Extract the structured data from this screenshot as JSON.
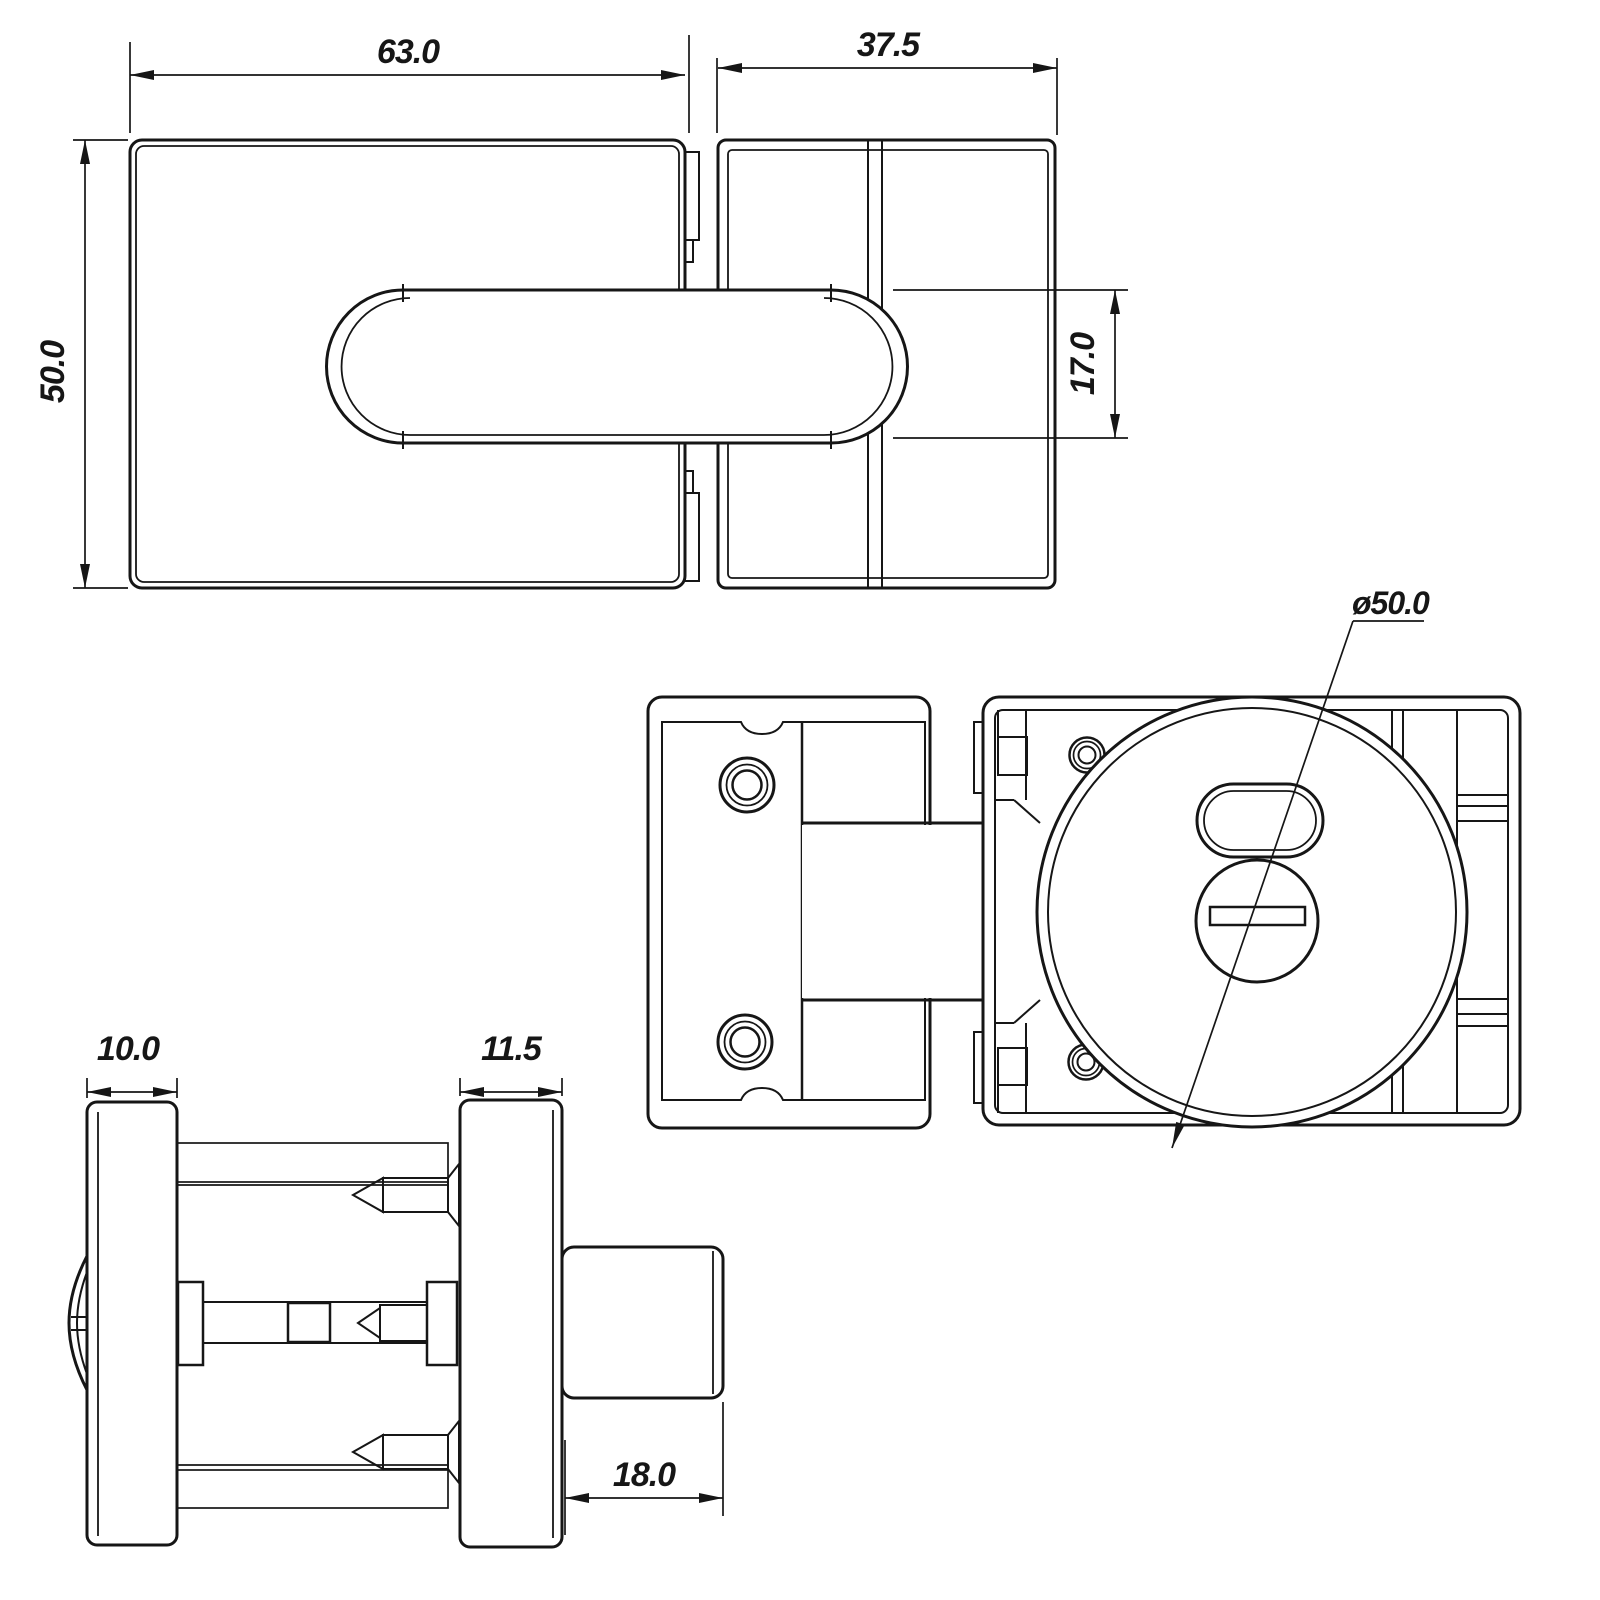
{
  "colors": {
    "background": "#ffffff",
    "line": "#161616"
  },
  "dimensions": {
    "body_width": "63.0",
    "strike_width": "37.5",
    "body_height": "50.0",
    "bolt_height": "17.0",
    "indicator_diameter": "ø50.0",
    "rose_thickness": "10.0",
    "plate_thickness": "11.5",
    "bolt_projection": "18.0"
  }
}
